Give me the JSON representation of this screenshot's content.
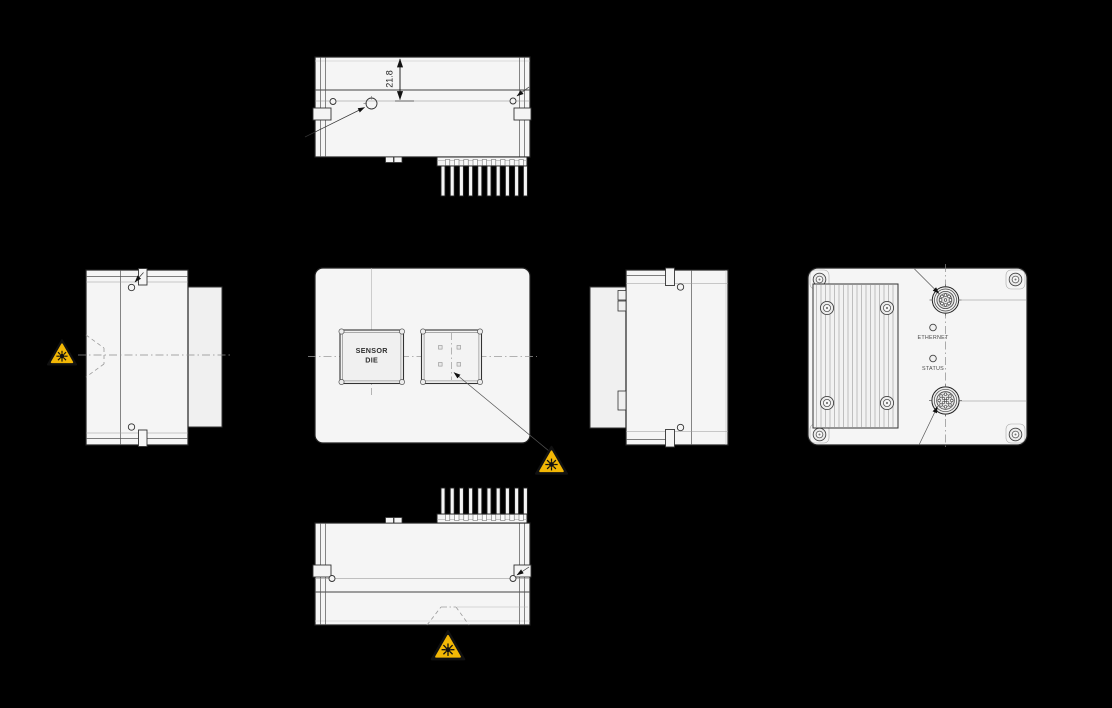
{
  "drawing": {
    "views": {
      "top": {
        "dimension_label": "21.8"
      },
      "front": {
        "sensor_die_line1": "SENSOR",
        "sensor_die_line2": "DIE"
      },
      "back": {
        "ethernet_label": "ETHERNET",
        "status_label": "STATUS"
      }
    },
    "icons": {
      "laser_warning": "laser-warning-icon"
    },
    "colors": {
      "background": "#000000",
      "body_fill": "#f5f5f5",
      "panel_fill": "#f0f0f0",
      "line_dark": "#1f1f1f",
      "warning_yellow": "#F2B705",
      "warning_black": "#111111"
    }
  }
}
